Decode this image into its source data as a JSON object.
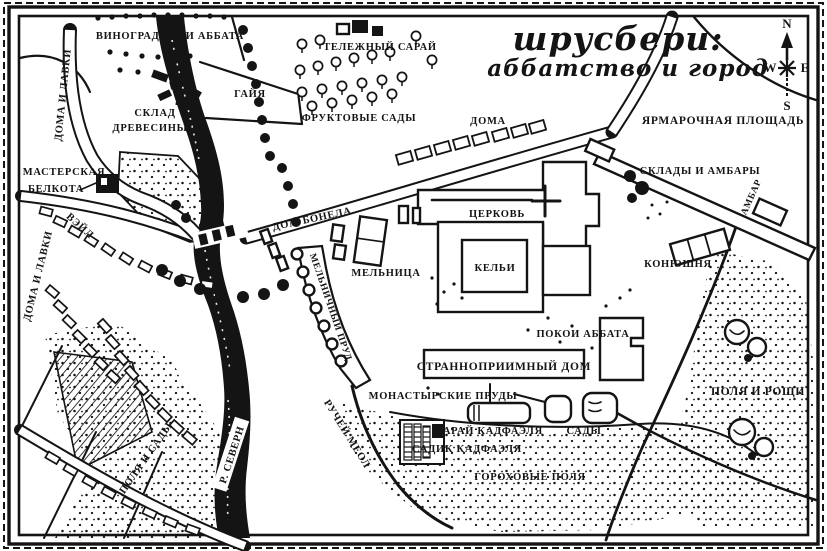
{
  "title": {
    "line1": "шрусбери:",
    "line2": "аббатство и город"
  },
  "compass": {
    "north": "N",
    "west": "W",
    "east": "E",
    "south": "S"
  },
  "labels": {
    "abbots_vineyards": "ВИНОГРАДНИКИ АББАТА",
    "houses_and_shops_upper": "ДОМА И ЛАВКИ",
    "cart_shed": "ТЕЛЕЖНЫЙ САРАЙ",
    "gaye": "ГАЙЯ",
    "timber_yard_line1": "СКЛАД",
    "timber_yard_line2": "ДРЕВЕСИНЫ",
    "fruit_orchards": "ФРУКТОВЫЕ САДЫ",
    "houses": "ДОМА",
    "fairground": "ЯРМАРОЧНАЯ ПЛОЩАДЬ",
    "warehouses_and_barns": "СКЛАДЫ И АМБАРЫ",
    "barn": "АМБАР",
    "belcote_workshop_line1": "МАСТЕРСКАЯ",
    "belcote_workshop_line2": "БЕЛКОТА",
    "wyle": "ВЭЙЛ",
    "bonel_house": "ДОМ БОНЕЛА",
    "church": "ЦЕРКОВЬ",
    "cells": "КЕЛЬИ",
    "mill": "МЕЛЬНИЦА",
    "mill_pond": "МЕЛЬНИЧНЫЙ ПРУД",
    "stables": "КОНЮШНЯ",
    "abbots_lodging": "ПОКОИ АББАТА",
    "guest_hall": "СТРАННОПРИИМНЫЙ ДОМ",
    "houses_and_shops_lower": "ДОМА И ЛАВКИ",
    "meole_brook": "РУЧЕЙ МЕОЛ",
    "abbey_ponds": "МОНАСТЫРСКИЕ ПРУДЫ",
    "cadfael_shed": "САРАЙ КАДФАЭЛЯ",
    "gardens": "САДЫ",
    "cadfael_garden": "САДИК КАДФАЭЛЯ",
    "pea_fields": "ГОРОХОВЫЕ ПОЛЯ",
    "fields_and_groves": "ПОЛЯ И РОЩИ",
    "fields_and_orchards": "ПОЛЯ И САДЫ",
    "river_severn": "Р. СЕВЕРН"
  },
  "colors": {
    "ink": "#141414",
    "paper": "#ffffff"
  }
}
